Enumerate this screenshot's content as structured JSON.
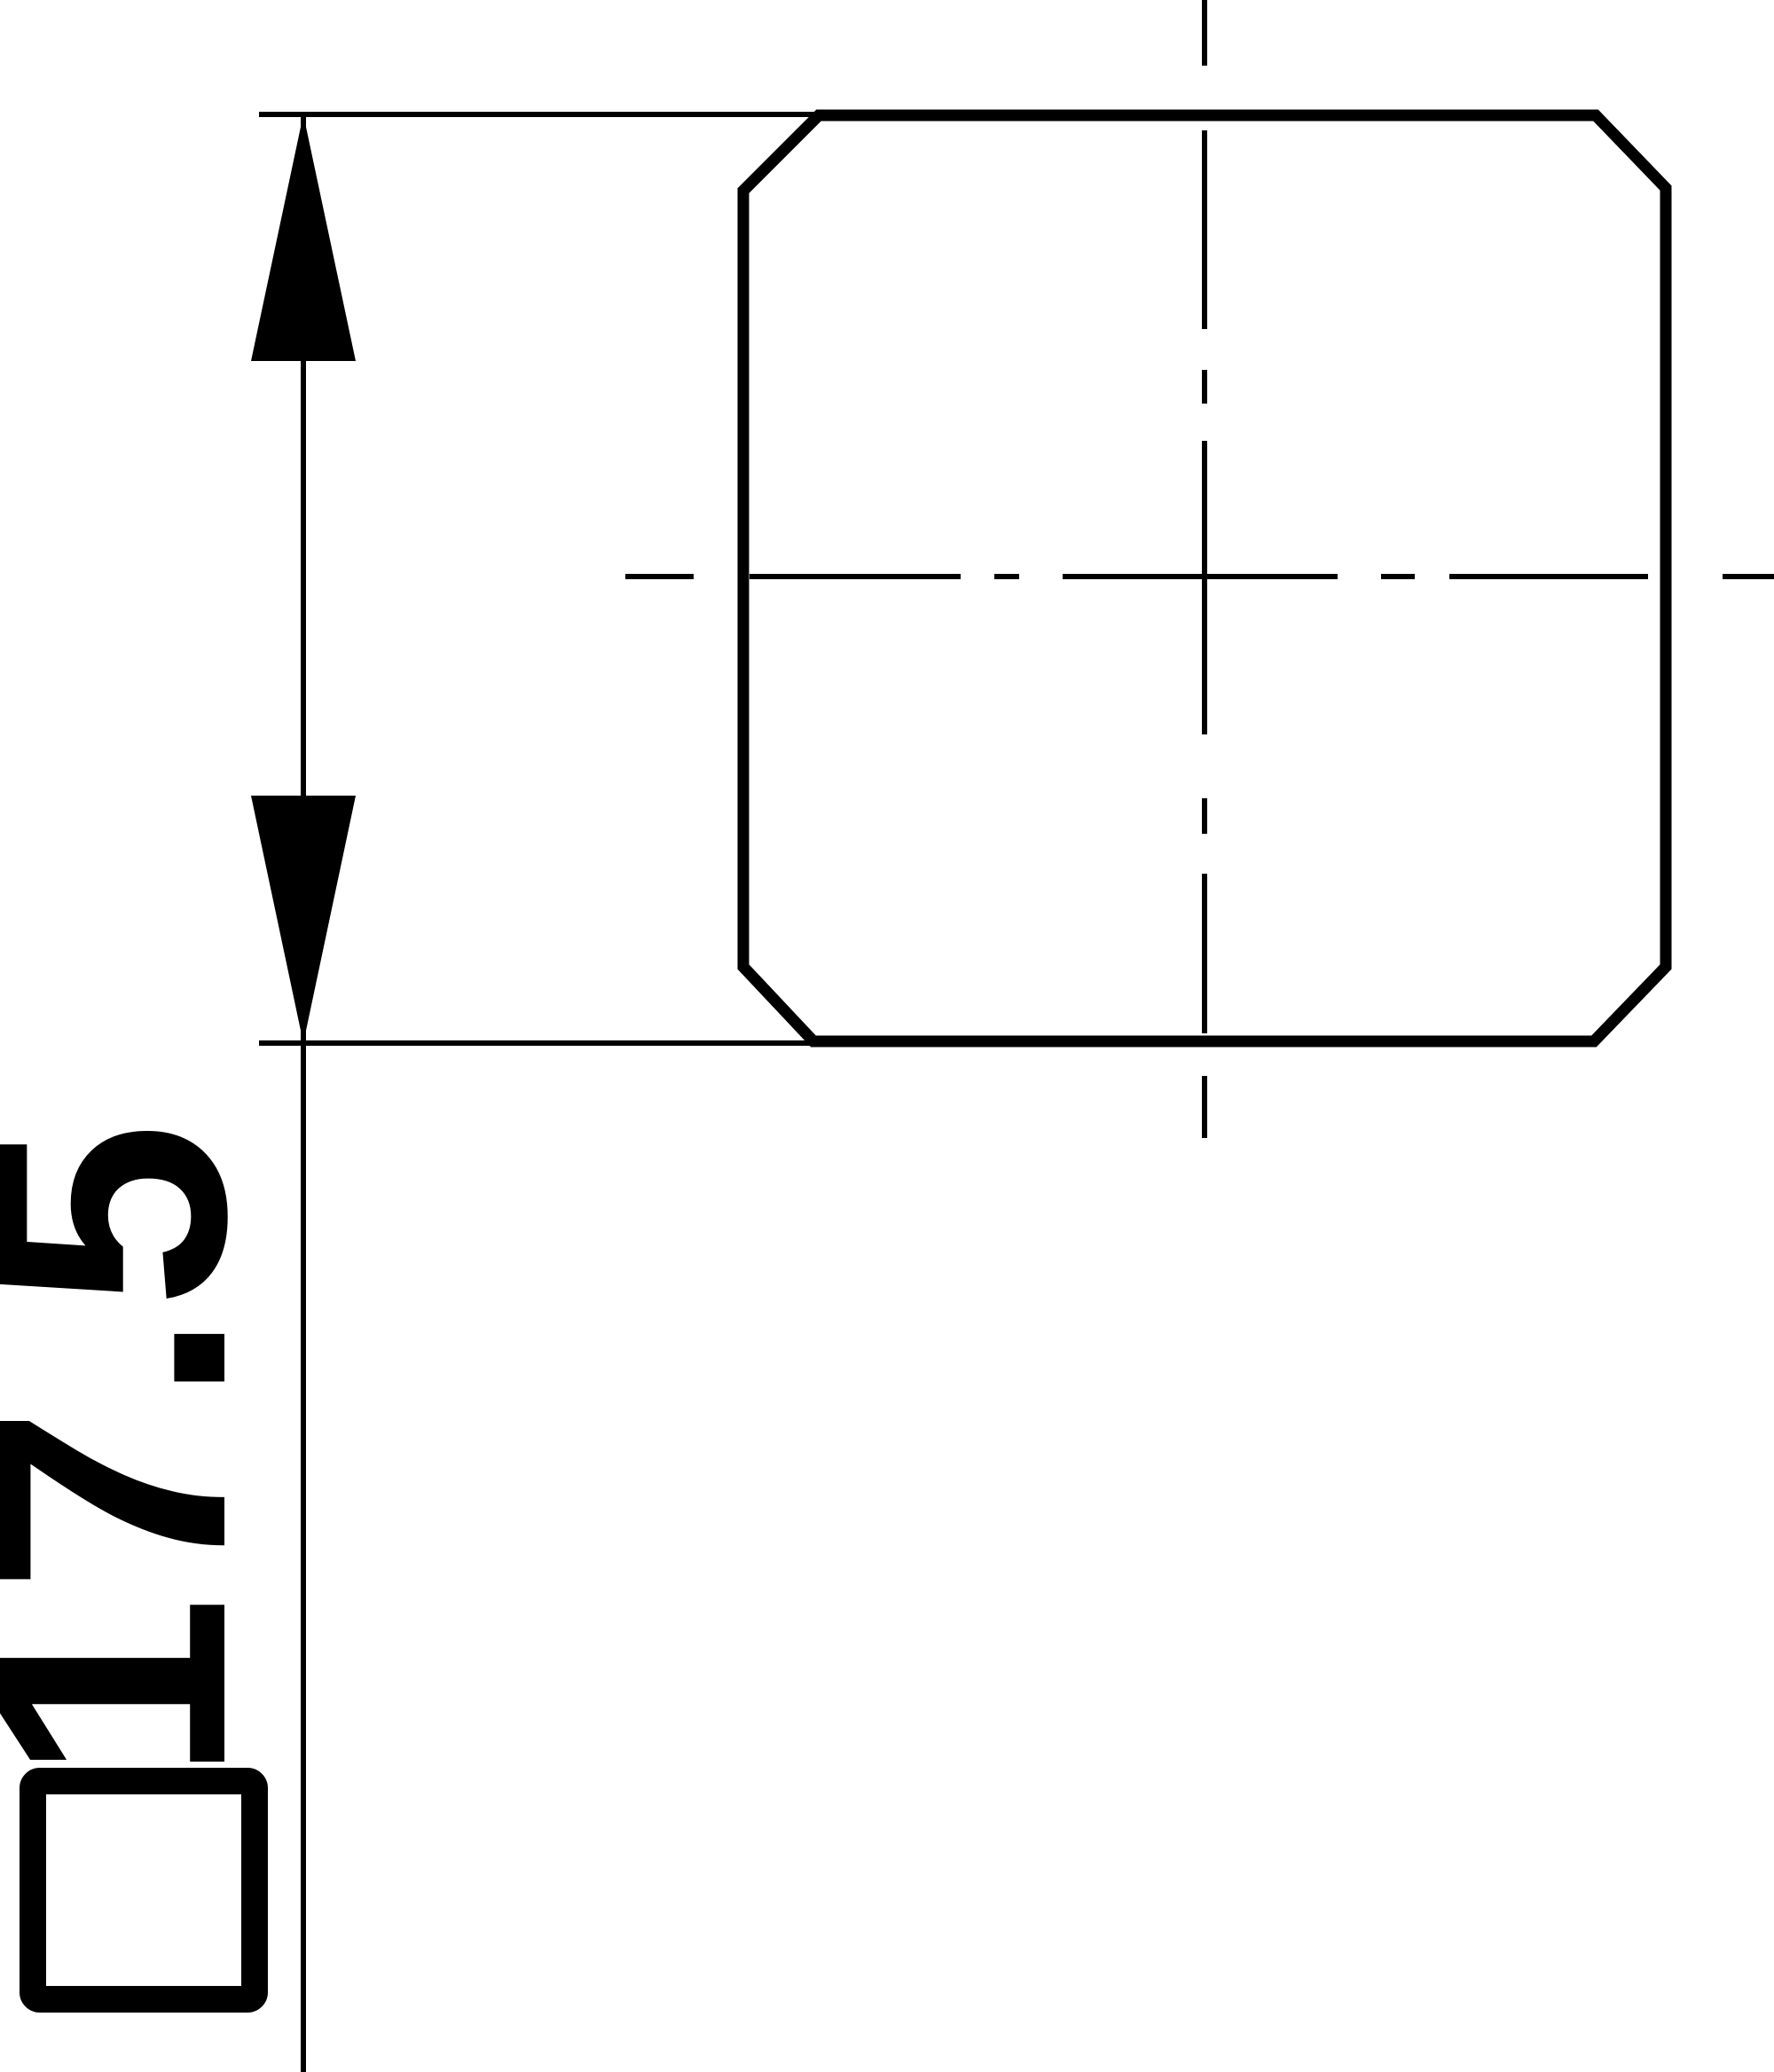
{
  "drawing": {
    "kind": "technical-drawing-end-view",
    "shape": "square with chamfered corners",
    "dimension": {
      "symbol": "□",
      "value": "17.5",
      "label": "□17.5"
    },
    "colors": {
      "ink": "#000000",
      "background": "#ffffff"
    }
  }
}
